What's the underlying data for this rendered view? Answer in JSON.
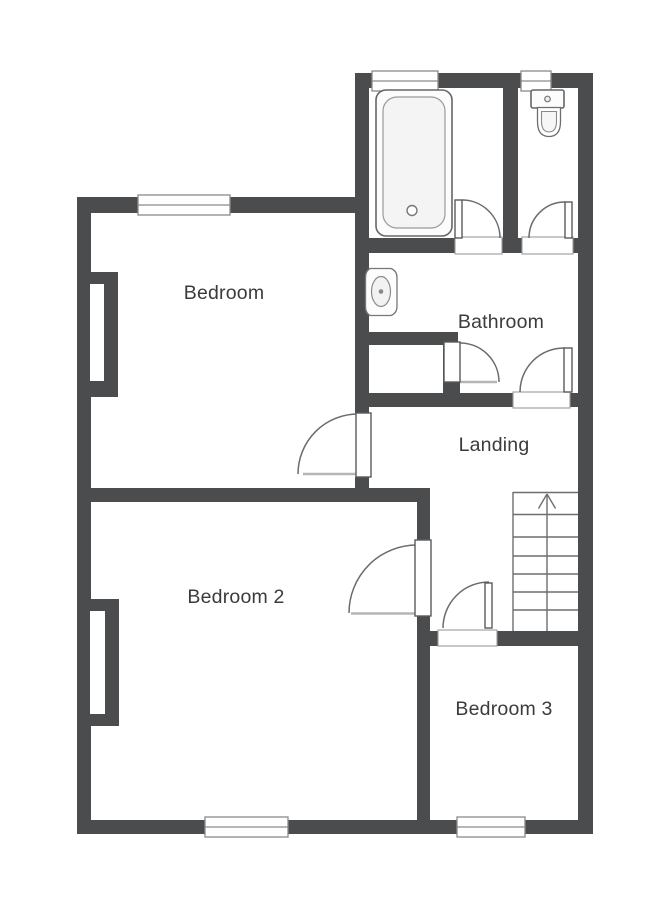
{
  "page": {
    "type": "floor-plan",
    "background": "#ffffff"
  },
  "colors": {
    "wall": "#4a4c4e",
    "outline": "#6b6b6b",
    "label_text": "#3b3b3b",
    "fixture_fill": "#f4f4f4"
  },
  "rooms": [
    {
      "name": "Bedroom"
    },
    {
      "name": "Bathroom"
    },
    {
      "name": "Landing"
    },
    {
      "name": "Bedroom 2"
    },
    {
      "name": "Bedroom 3"
    }
  ],
  "fixtures": [
    {
      "name": "bathtub"
    },
    {
      "name": "toilet"
    },
    {
      "name": "wash-basin"
    },
    {
      "name": "staircase",
      "direction": "up"
    },
    {
      "name": "chimney-breast-bedroom"
    },
    {
      "name": "chimney-breast-bedroom-2"
    }
  ],
  "counts": {
    "windows": 5,
    "doors": 7
  }
}
